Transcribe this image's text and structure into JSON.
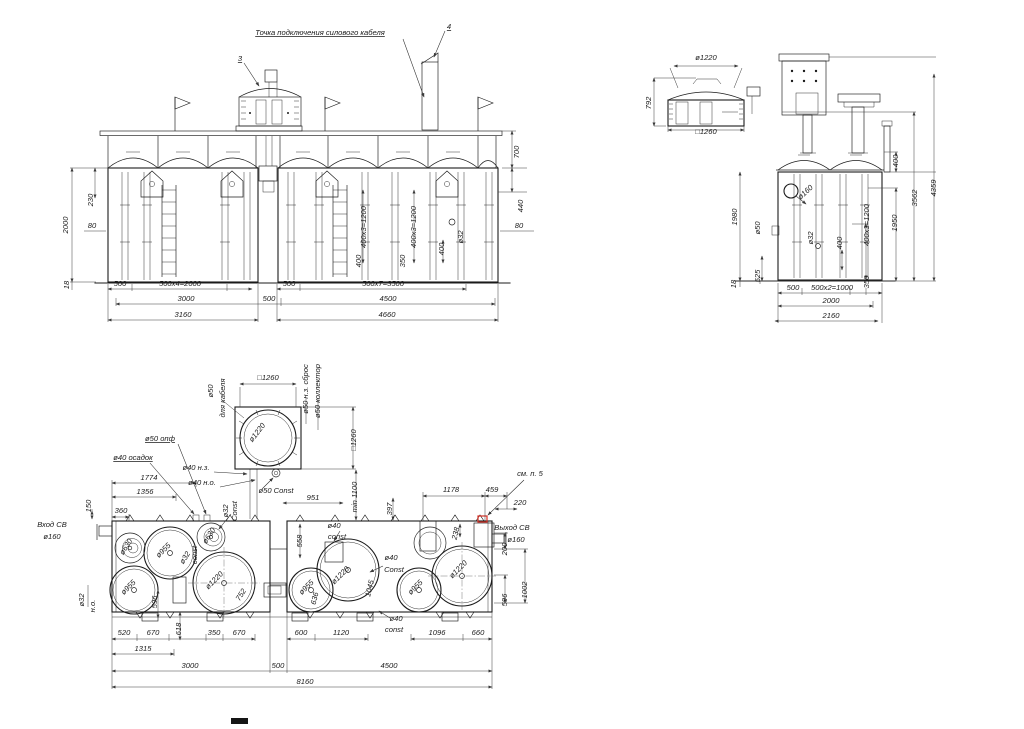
{
  "drawing": {
    "colors": {
      "line": "#1b1b1b",
      "dim": "#3a3a3a",
      "highlight": "#d93025",
      "background": "#ffffff"
    },
    "labels": {
      "front": [
        {
          "t": "Точка подключения силового кабеля",
          "x": 320,
          "y": 35,
          "ul": 1,
          "s": 9
        },
        {
          "t": "3",
          "x": 240,
          "y": 61,
          "ul": 1,
          "s": 9
        },
        {
          "t": "4",
          "x": 449,
          "y": 29,
          "ul": 1,
          "s": 9
        },
        {
          "t": "2000",
          "x": 68,
          "y": 225,
          "r": -90
        },
        {
          "t": "230",
          "x": 93,
          "y": 200,
          "r": -90
        },
        {
          "t": "80",
          "x": 92,
          "y": 228
        },
        {
          "t": "18",
          "x": 69,
          "y": 285,
          "r": -90
        },
        {
          "t": "500",
          "x": 120,
          "y": 286
        },
        {
          "t": "500x4=2000",
          "x": 180,
          "y": 286
        },
        {
          "t": "3000",
          "x": 186,
          "y": 301
        },
        {
          "t": "500",
          "x": 269,
          "y": 301
        },
        {
          "t": "3160",
          "x": 183,
          "y": 317
        },
        {
          "t": "500",
          "x": 289,
          "y": 286
        },
        {
          "t": "500x7=3500",
          "x": 383,
          "y": 286
        },
        {
          "t": "4500",
          "x": 388,
          "y": 301
        },
        {
          "t": "4660",
          "x": 387,
          "y": 317
        },
        {
          "t": "700",
          "x": 519,
          "y": 152,
          "r": -90
        },
        {
          "t": "440",
          "x": 523,
          "y": 206,
          "r": -90
        },
        {
          "t": "80",
          "x": 519,
          "y": 228
        },
        {
          "t": "ø32",
          "x": 463,
          "y": 237,
          "r": -90
        },
        {
          "t": "400",
          "x": 444,
          "y": 249,
          "r": -90
        },
        {
          "t": "400x3=1200",
          "x": 416,
          "y": 227,
          "r": -90
        },
        {
          "t": "350",
          "x": 405,
          "y": 261,
          "r": -90
        },
        {
          "t": "400x3=1200",
          "x": 366,
          "y": 227,
          "r": -90
        },
        {
          "t": "400",
          "x": 361,
          "y": 261,
          "r": -90
        }
      ],
      "detail_top": [
        {
          "t": "ø1220",
          "x": 706,
          "y": 60,
          "s": 8.5
        },
        {
          "t": "792",
          "x": 651,
          "y": 103,
          "r": -90
        },
        {
          "t": "□1260",
          "x": 706,
          "y": 134
        }
      ],
      "side": [
        {
          "t": "4359",
          "x": 936,
          "y": 188,
          "r": -90
        },
        {
          "t": "3562",
          "x": 917,
          "y": 198,
          "r": -90
        },
        {
          "t": "400",
          "x": 898,
          "y": 161,
          "r": -90
        },
        {
          "t": "1950",
          "x": 897,
          "y": 223,
          "r": -90
        },
        {
          "t": "400x3=1200",
          "x": 869,
          "y": 225,
          "r": -90
        },
        {
          "t": "400",
          "x": 842,
          "y": 243,
          "r": -90
        },
        {
          "t": "ø32",
          "x": 813,
          "y": 238,
          "r": -90
        },
        {
          "t": "ø50",
          "x": 760,
          "y": 228,
          "r": -90
        },
        {
          "t": "ø160",
          "x": 807,
          "y": 194,
          "r": -42
        },
        {
          "t": "1980",
          "x": 737,
          "y": 217,
          "r": -90
        },
        {
          "t": "18",
          "x": 736,
          "y": 284,
          "r": -90
        },
        {
          "t": "525",
          "x": 760,
          "y": 276,
          "r": -90
        },
        {
          "t": "500",
          "x": 793,
          "y": 290
        },
        {
          "t": "500x2=1000",
          "x": 832,
          "y": 290
        },
        {
          "t": "350",
          "x": 869,
          "y": 282,
          "r": -90
        },
        {
          "t": "2000",
          "x": 831,
          "y": 303
        },
        {
          "t": "2160",
          "x": 831,
          "y": 318
        }
      ],
      "hatch": [
        {
          "t": "□1260",
          "x": 268,
          "y": 380
        },
        {
          "t": "ø50",
          "x": 213,
          "y": 391,
          "r": -90
        },
        {
          "t": "для кабеля",
          "x": 225,
          "y": 398,
          "r": -90
        },
        {
          "t": "ø1220",
          "x": 259,
          "y": 434,
          "r": -52
        },
        {
          "t": "ø50 н.з. сброс",
          "x": 308,
          "y": 389,
          "r": -90
        },
        {
          "t": "ø50 коллектор",
          "x": 320,
          "y": 391,
          "r": -90
        },
        {
          "t": "□1260",
          "x": 356,
          "y": 440,
          "r": -90
        },
        {
          "t": "ø40 н.з.",
          "x": 196,
          "y": 470
        },
        {
          "t": "ø40 н.о.",
          "x": 202,
          "y": 485
        },
        {
          "t": "ø50 Const",
          "x": 276,
          "y": 493
        },
        {
          "t": "min 1100",
          "x": 357,
          "y": 497,
          "r": -90
        },
        {
          "t": "951",
          "x": 313,
          "y": 500
        },
        {
          "t": "397",
          "x": 392,
          "y": 509,
          "r": -90
        }
      ],
      "plan": [
        {
          "t": "ø50 опф",
          "x": 160,
          "y": 441,
          "ul": 1
        },
        {
          "t": "ø40 осадок",
          "x": 133,
          "y": 460,
          "ul": 1
        },
        {
          "t": "1774",
          "x": 149,
          "y": 480
        },
        {
          "t": "1356",
          "x": 145,
          "y": 494
        },
        {
          "t": "150",
          "x": 91,
          "y": 506,
          "r": -90
        },
        {
          "t": "360",
          "x": 121,
          "y": 513
        },
        {
          "t": "Вход СВ",
          "x": 52,
          "y": 527,
          "a": "start"
        },
        {
          "t": "ø160",
          "x": 52,
          "y": 539,
          "a": "start"
        },
        {
          "t": "ø32",
          "x": 228,
          "y": 511,
          "r": -90
        },
        {
          "t": "Const",
          "x": 237,
          "y": 511,
          "r": -90
        },
        {
          "t": "ø630",
          "x": 128,
          "y": 548,
          "r": -58
        },
        {
          "t": "ø955",
          "x": 165,
          "y": 552,
          "r": -45
        },
        {
          "t": "ø32",
          "x": 187,
          "y": 559,
          "r": -58
        },
        {
          "t": "const",
          "x": 197,
          "y": 555,
          "r": -90
        },
        {
          "t": "ø630",
          "x": 211,
          "y": 537,
          "r": -58
        },
        {
          "t": "ø955",
          "x": 130,
          "y": 589,
          "r": -45
        },
        {
          "t": "ø1220",
          "x": 216,
          "y": 582,
          "r": -45
        },
        {
          "t": "752",
          "x": 243,
          "y": 596,
          "r": -58
        },
        {
          "t": "596",
          "x": 157,
          "y": 602,
          "r": -90
        },
        {
          "t": "ø32",
          "x": 84,
          "y": 600,
          "r": -90
        },
        {
          "t": "н.о.",
          "x": 95,
          "y": 606,
          "r": -90
        },
        {
          "t": "520",
          "x": 124,
          "y": 635
        },
        {
          "t": "670",
          "x": 153,
          "y": 635
        },
        {
          "t": "618",
          "x": 181,
          "y": 629,
          "r": -90
        },
        {
          "t": "350",
          "x": 214,
          "y": 635
        },
        {
          "t": "670",
          "x": 239,
          "y": 635
        },
        {
          "t": "1315",
          "x": 143,
          "y": 651
        },
        {
          "t": "3000",
          "x": 190,
          "y": 668
        },
        {
          "t": "500",
          "x": 278,
          "y": 668
        },
        {
          "t": "600",
          "x": 301,
          "y": 635
        },
        {
          "t": "1120",
          "x": 341,
          "y": 635
        },
        {
          "t": "ø40",
          "x": 396,
          "y": 621
        },
        {
          "t": "const",
          "x": 394,
          "y": 632
        },
        {
          "t": "1096",
          "x": 437,
          "y": 635
        },
        {
          "t": "660",
          "x": 478,
          "y": 635
        },
        {
          "t": "4500",
          "x": 389,
          "y": 668
        },
        {
          "t": "8160",
          "x": 305,
          "y": 684
        },
        {
          "t": "558",
          "x": 302,
          "y": 541,
          "r": -90
        },
        {
          "t": "ø40",
          "x": 334,
          "y": 528
        },
        {
          "t": "const",
          "x": 337,
          "y": 539
        },
        {
          "t": "ø1220",
          "x": 342,
          "y": 577,
          "r": -45
        },
        {
          "t": "1045",
          "x": 372,
          "y": 589,
          "r": -76
        },
        {
          "t": "ø40",
          "x": 391,
          "y": 560
        },
        {
          "t": "Const",
          "x": 394,
          "y": 572
        },
        {
          "t": "ø955",
          "x": 308,
          "y": 589,
          "r": -45
        },
        {
          "t": "636",
          "x": 317,
          "y": 599,
          "r": -76
        },
        {
          "t": "ø955",
          "x": 417,
          "y": 589,
          "r": -45
        },
        {
          "t": "ø1220",
          "x": 460,
          "y": 571,
          "r": -45
        },
        {
          "t": "238",
          "x": 458,
          "y": 534,
          "r": -76
        },
        {
          "t": "1178",
          "x": 451,
          "y": 492
        },
        {
          "t": "459",
          "x": 492,
          "y": 492
        },
        {
          "t": "220",
          "x": 520,
          "y": 505
        },
        {
          "t": "см. п. 5",
          "x": 530,
          "y": 476
        },
        {
          "t": "Выход СВ",
          "x": 512,
          "y": 530,
          "a": "start"
        },
        {
          "t": "ø160",
          "x": 516,
          "y": 542,
          "a": "start"
        },
        {
          "t": "200",
          "x": 507,
          "y": 549,
          "r": -90
        },
        {
          "t": "596",
          "x": 507,
          "y": 600,
          "r": -90
        },
        {
          "t": "1002",
          "x": 527,
          "y": 590,
          "r": -90
        }
      ]
    }
  }
}
